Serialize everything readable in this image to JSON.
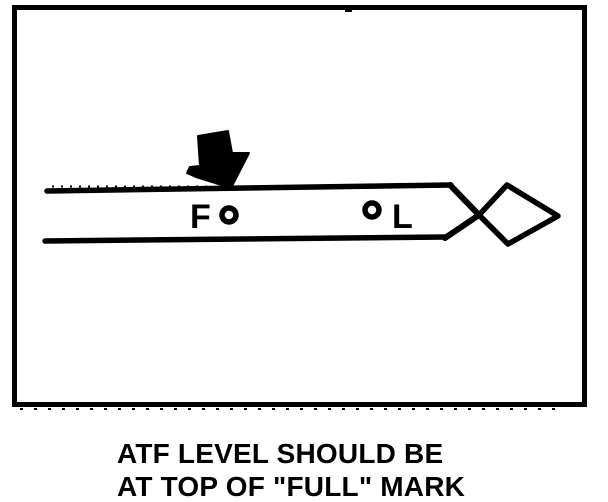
{
  "figure": {
    "caption": {
      "line1": "ATF LEVEL SHOULD BE",
      "line2": "AT TOP OF \"FULL\" MARK"
    },
    "diagram": {
      "full_mark_label": "F",
      "low_mark_label": "L"
    },
    "colors": {
      "ink": "#000000",
      "background": "#ffffff"
    }
  }
}
